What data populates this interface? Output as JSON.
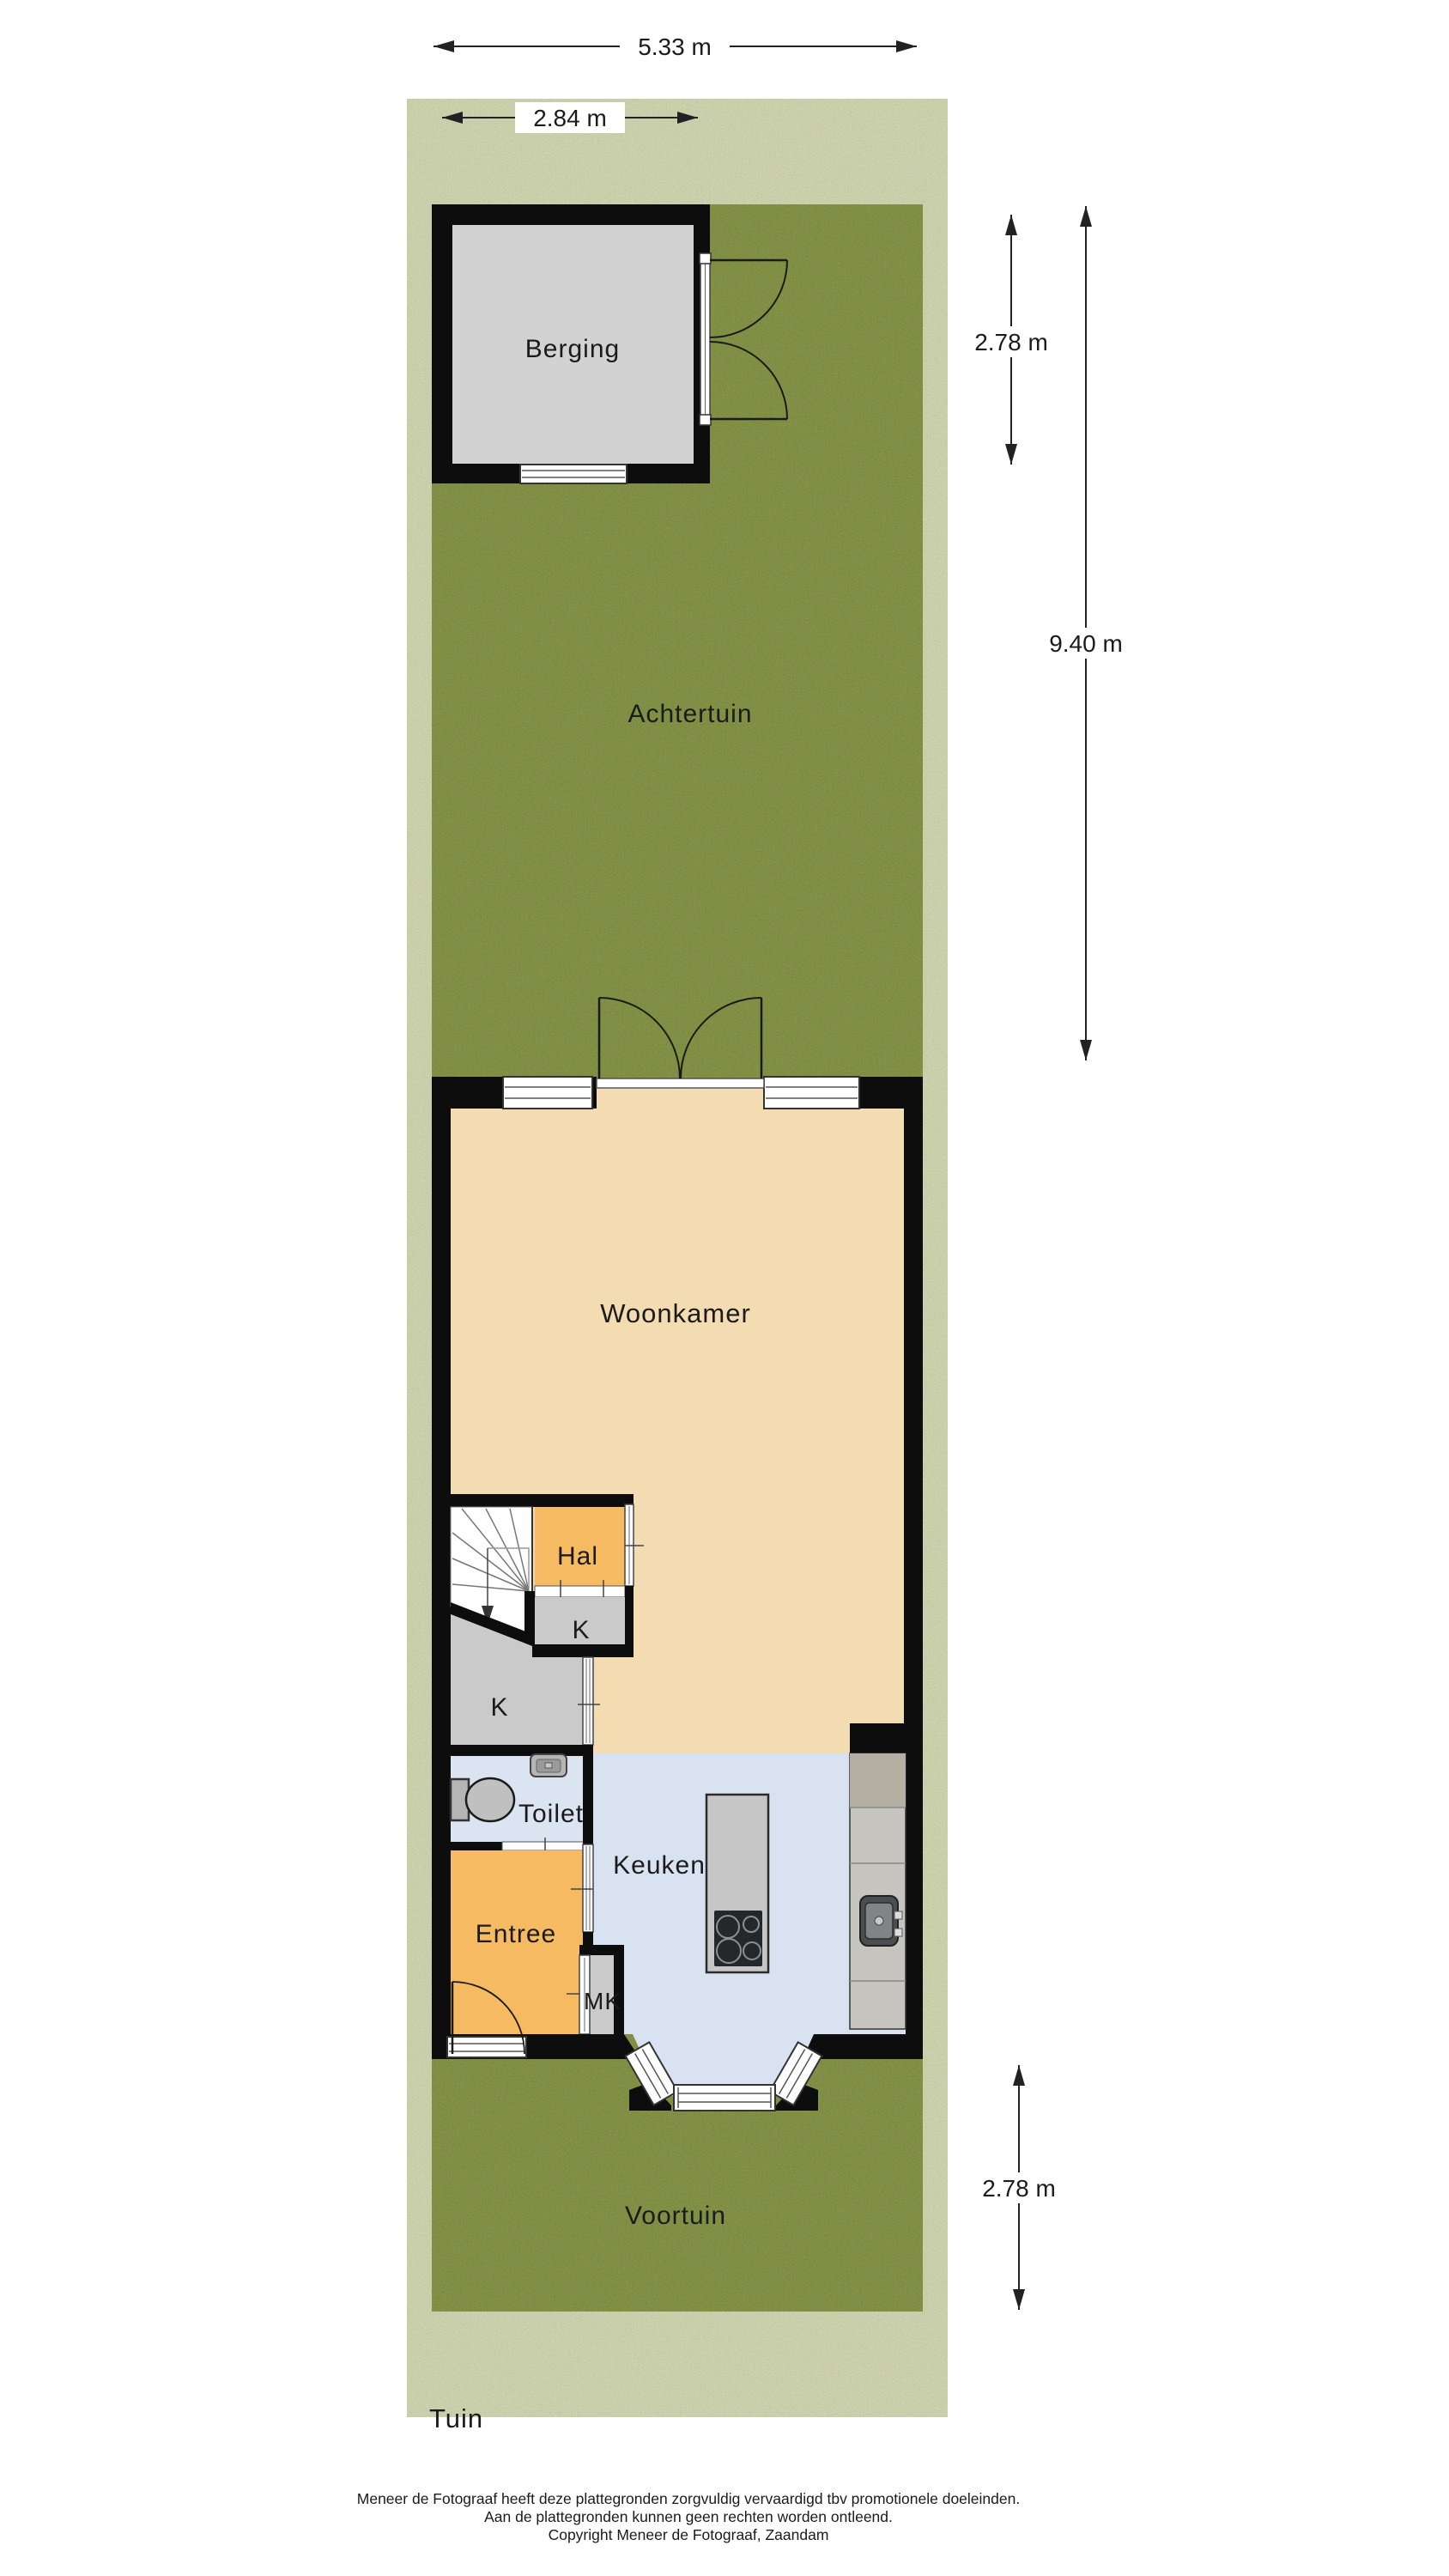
{
  "page": {
    "title": "Tuin"
  },
  "dimensions": {
    "total_width": "5.33 m",
    "berging_width": "2.84 m",
    "berging_depth": "2.78 m",
    "achtertuin_depth": "9.40 m",
    "voortuin_depth": "2.78 m"
  },
  "rooms": {
    "berging": "Berging",
    "achtertuin": "Achtertuin",
    "woonkamer": "Woonkamer",
    "hal": "Hal",
    "kast_bij_hal": "K",
    "kast_onder_trap": "K",
    "toilet": "Toilet",
    "keuken": "Keuken",
    "entree": "Entree",
    "meterkast": "MK",
    "voortuin": "Voortuin"
  },
  "footer": {
    "line1": "Meneer de Fotograaf heeft deze plattegronden zorgvuldig vervaardigd tbv promotionele doeleinden.",
    "line2": "Aan de plattegronden kunnen geen rechten worden ontleend.",
    "line3": "Copyright Meneer de Fotograaf, Zaandam"
  },
  "colors": {
    "grass": "#7b8a45",
    "wall": "#0d0d0d",
    "woonkamer_floor": "#f3dcb2",
    "hal_floor": "#f6ba62",
    "entree_floor": "#f6ba62",
    "closet_floor": "#cacaca",
    "toilet_floor": "#dbe4f1",
    "keuken_floor": "#d8e2f0",
    "berging_floor": "#d2d2d2",
    "counter": "#c6c5c0",
    "counter_top_segment": "#b3b0a3",
    "island": "#c6c6c6",
    "cooktop": "#24282b"
  }
}
